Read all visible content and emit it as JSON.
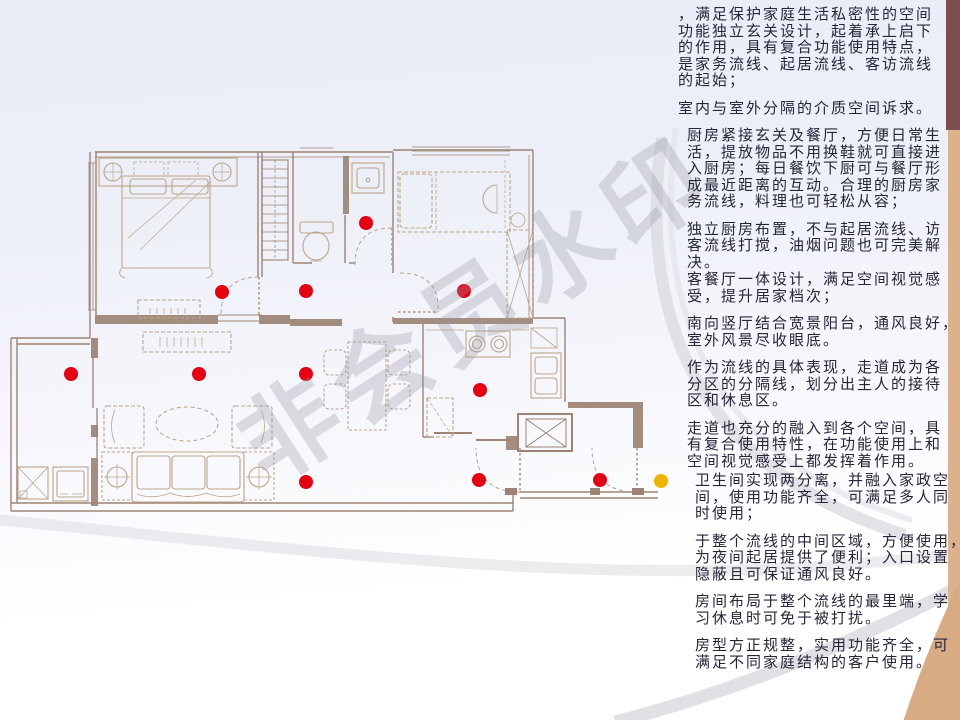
{
  "slide": {
    "watermark": "非会员水印",
    "colors": {
      "top_bar": "#7c4e4f",
      "side_bar": "#dcb18c",
      "corner_wedge": "#d8ab83",
      "swoosh": "#d9dadf",
      "wall_line": "#9c8474",
      "furniture_line": "#bca689",
      "text": "#26263a",
      "background_top": "#e9ebf7"
    }
  },
  "floor_plan": {
    "markers": {
      "radius": 7,
      "red_color": "#e60012",
      "yellow_color": "#f0b400",
      "points": [
        {
          "x": 222,
          "y": 292,
          "color": "red"
        },
        {
          "x": 306,
          "y": 291,
          "color": "red"
        },
        {
          "x": 366,
          "y": 223,
          "color": "red"
        },
        {
          "x": 464,
          "y": 291,
          "color": "red"
        },
        {
          "x": 71,
          "y": 374,
          "color": "red"
        },
        {
          "x": 199,
          "y": 374,
          "color": "red"
        },
        {
          "x": 306,
          "y": 374,
          "color": "red"
        },
        {
          "x": 480,
          "y": 390,
          "color": "red"
        },
        {
          "x": 306,
          "y": 482,
          "color": "red"
        },
        {
          "x": 479,
          "y": 480,
          "color": "red"
        },
        {
          "x": 600,
          "y": 480,
          "color": "red"
        },
        {
          "x": 661,
          "y": 481,
          "color": "yellow"
        }
      ]
    }
  },
  "annotations": {
    "paragraphs": [
      {
        "lines": [
          "，满足保护家庭生活私密性的空间",
          "功能独立玄关设计，起着承上启下",
          "的作用，具有复合功能使用特点，",
          "是家务流线、起居流线、客访流线",
          "的起始；"
        ]
      },
      {
        "lines": [
          "室内与室外分隔的介质空间诉求。"
        ]
      },
      {
        "lines": [
          "厨房紧接玄关及餐厅，方便日常生",
          "活，提放物品不用换鞋就可直接进",
          "入厨房；每日餐饮下厨可与餐厅形",
          "成最近距离的互动。合理的厨房家",
          "务流线，料理也可轻松从容；"
        ]
      },
      {
        "lines": [
          "独立厨房布置，不与起居流线、访",
          "客流线打搅，油烟问题也可完美解",
          "决。"
        ]
      },
      {
        "lines": [
          "客餐厅一体设计，满足空间视觉感",
          "受，提升居家档次；"
        ]
      },
      {
        "lines": [
          "南向竖厅结合宽景阳台，通风良好，",
          "室外风景尽收眼底。"
        ]
      },
      {
        "lines": [
          "作为流线的具体表现，走道成为各",
          "分区的分隔线，划分出主人的接待",
          "区和休息区。"
        ]
      },
      {
        "lines": [
          "走道也充分的融入到各个空间，具",
          "有复合使用特性，在功能使用上和",
          "空间视觉感受上都发挥着作用。"
        ]
      },
      {
        "lines": [
          "卫生间实现两分离，并融入家政空",
          "间，使用功能齐全，可满足多人同",
          "时使用；"
        ]
      },
      {
        "lines": [
          "于整个流线的中间区域，方便使用，",
          "为夜间起居提供了便利；入口设置",
          "隐蔽且可保证通风良好。"
        ]
      },
      {
        "lines": [
          "房间布局于整个流线的最里端，学",
          "习休息时可免于被打扰。"
        ]
      },
      {
        "lines": [
          "房型方正规整，实用功能齐全，可",
          "满足不同家庭结构的客户使用。"
        ]
      }
    ]
  }
}
